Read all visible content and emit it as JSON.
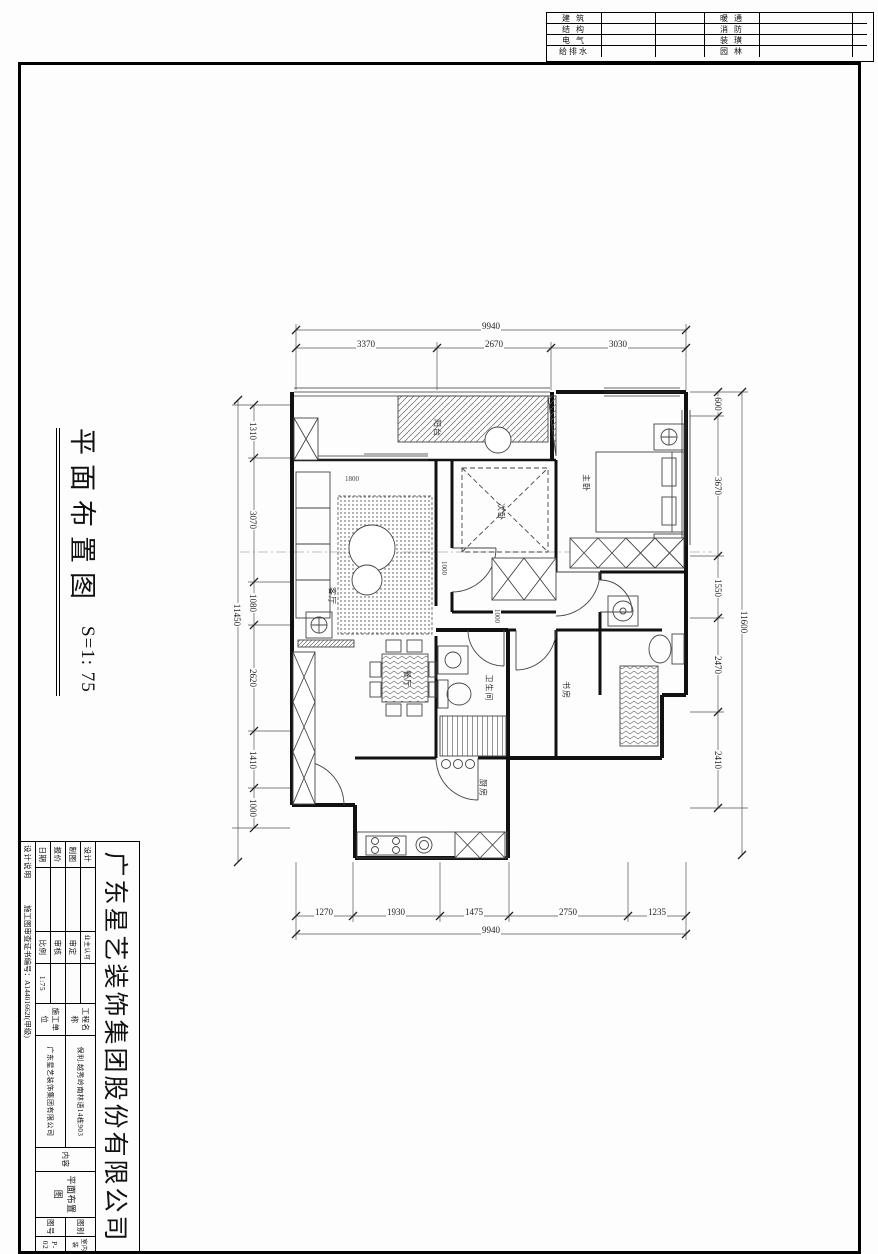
{
  "discipline_table": {
    "rows": [
      {
        "left": "建 筑",
        "right": "暖 通"
      },
      {
        "left": "结 构",
        "right": "消 防"
      },
      {
        "left": "电 气",
        "right": "装 璜"
      },
      {
        "left": "给排水",
        "right": "园 林"
      }
    ]
  },
  "drawing_title": {
    "text": "平面布置图",
    "scale": "S=1: 75"
  },
  "plan": {
    "rooms": [
      {
        "name": "阳台"
      },
      {
        "name": "客厅"
      },
      {
        "name": "餐厅"
      },
      {
        "name": "次卧"
      },
      {
        "name": "主卧"
      },
      {
        "name": "书房"
      },
      {
        "name": "卫生间"
      },
      {
        "name": "厨房"
      }
    ],
    "dims_top": {
      "overall": "9940",
      "segments": [
        "3370",
        "2670",
        "3030"
      ]
    },
    "dims_bottom": {
      "overall": "9940",
      "segments": [
        "1270",
        "1930",
        "1475",
        "2750",
        "1235"
      ]
    },
    "dims_left": {
      "overall": "11450",
      "segments": [
        "1310",
        "3070",
        "1080",
        "2620",
        "1410",
        "1000"
      ]
    },
    "dims_right": {
      "overall": "11600",
      "segments": [
        "600",
        "3670",
        "1550",
        "2470",
        "2410"
      ]
    },
    "inner_dims": [
      "1800",
      "1000",
      "1000"
    ]
  },
  "title_block": {
    "company": "广东星艺装饰集团股份有限公司",
    "col1": [
      {
        "label": "设计",
        "value": ""
      },
      {
        "label": "制图",
        "value": ""
      },
      {
        "label": "报价",
        "value": ""
      },
      {
        "label": "日期",
        "value": ""
      }
    ],
    "col2": [
      {
        "label": "业主认可",
        "value": ""
      },
      {
        "label": "审定",
        "value": ""
      },
      {
        "label": "审核",
        "value": ""
      },
      {
        "label": "比例",
        "value": "1:75"
      }
    ],
    "project": {
      "label": "工程名称",
      "value": "保利.越秀岭南林语14栋903"
    },
    "builder": {
      "label": "施工单位",
      "value": "广东星艺装饰集团有限公司"
    },
    "content": {
      "label": "内容",
      "value": "平面布置图"
    },
    "sheet_type": {
      "label": "图别",
      "value": "室内装"
    },
    "sheet_no": {
      "label": "图号",
      "value": "P-02"
    },
    "note": "设计说明",
    "certificate": "施工图审查证书编号：A14401662I(甲级)"
  }
}
